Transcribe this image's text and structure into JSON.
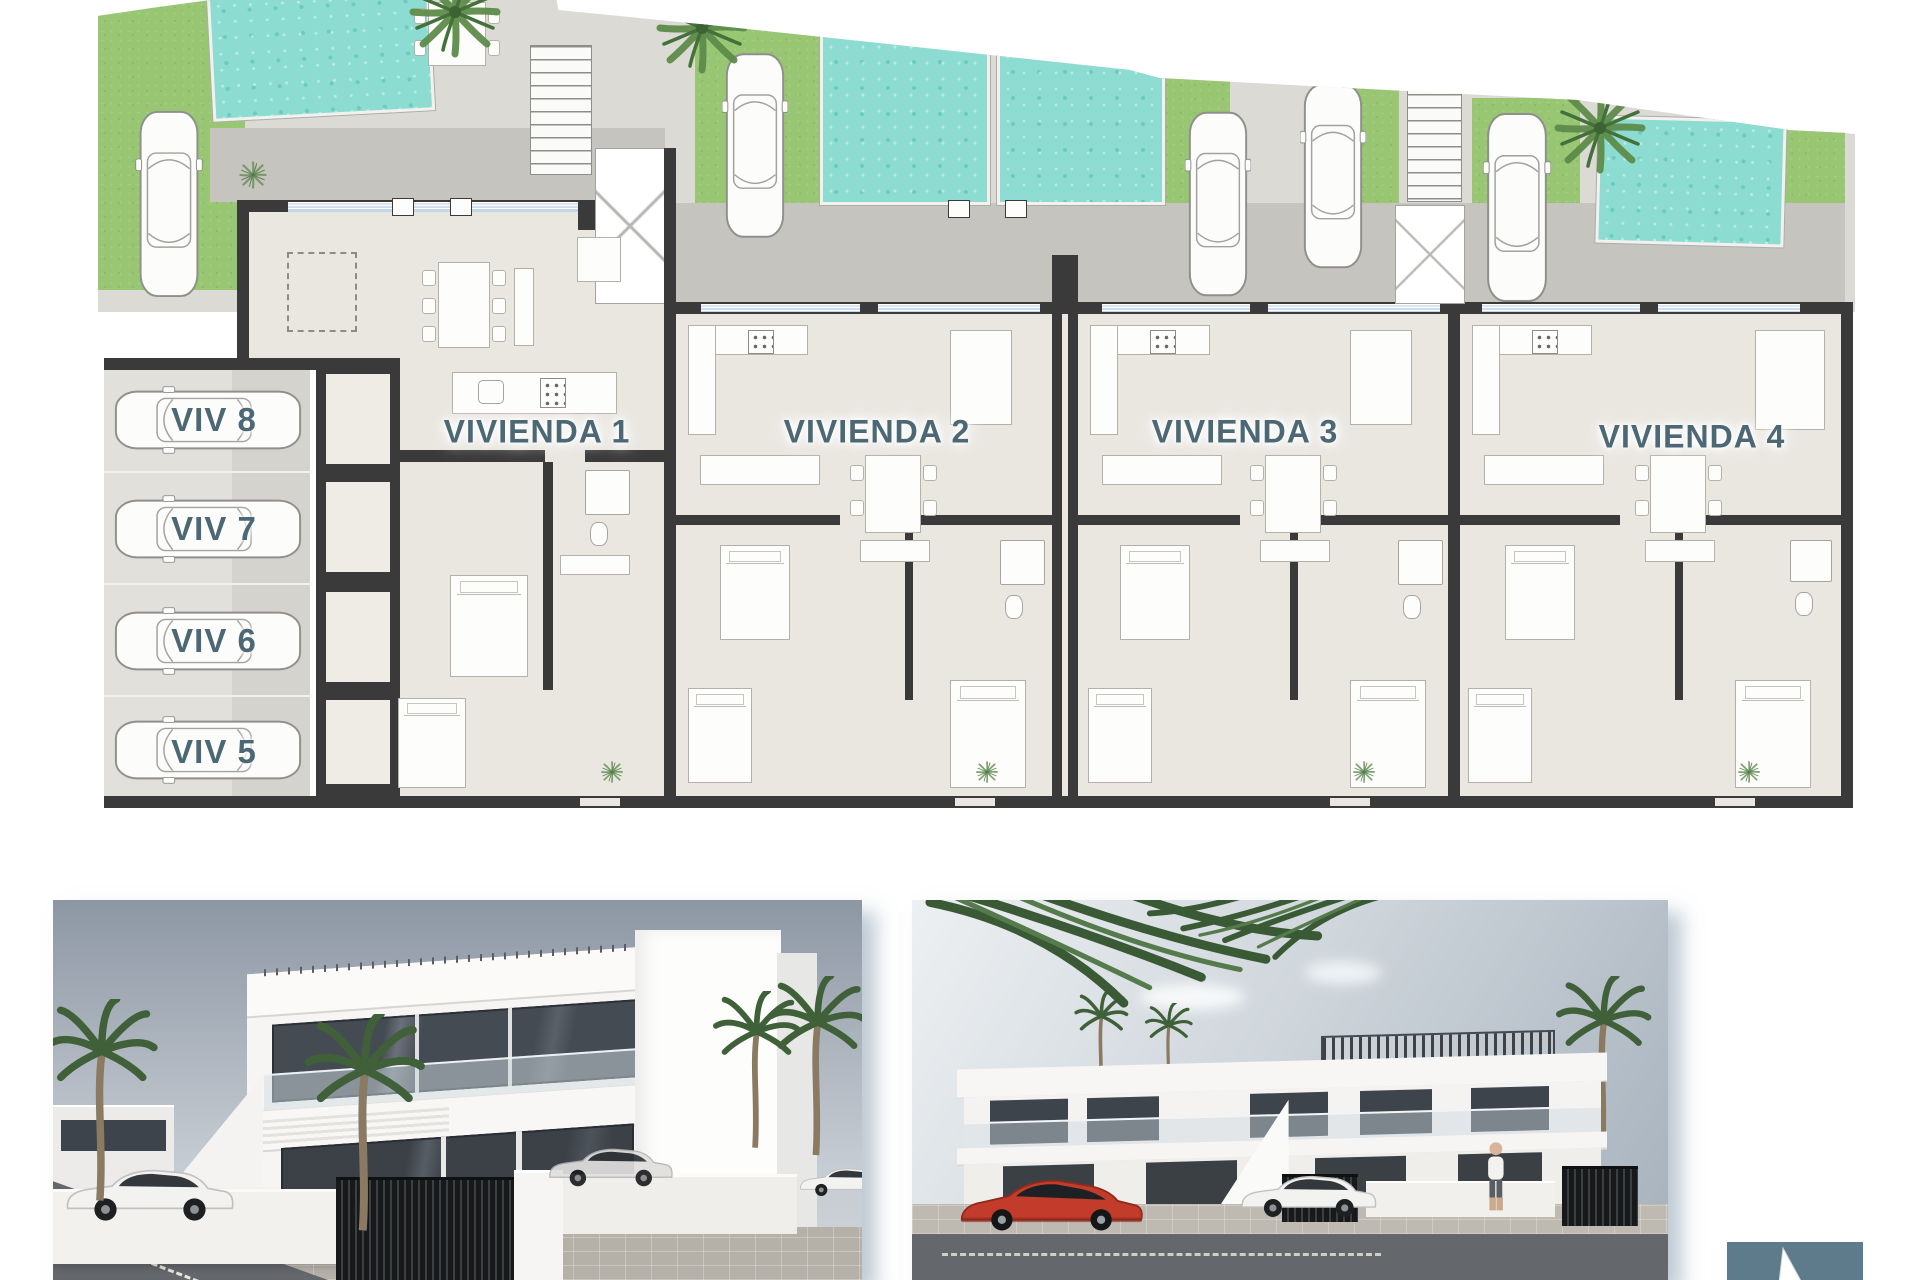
{
  "document": {
    "kind": "residential floor plan sheet with two exterior renders"
  },
  "plan": {
    "units": [
      {
        "label": "VIVIENDA 1"
      },
      {
        "label": "VIVIENDA 2"
      },
      {
        "label": "VIVIENDA 3"
      },
      {
        "label": "VIVIENDA 4"
      }
    ],
    "parking_stalls": [
      {
        "label": "VIV 8"
      },
      {
        "label": "VIV 7"
      },
      {
        "label": "VIV 6"
      },
      {
        "label": "VIV 5"
      }
    ]
  },
  "icons": {
    "car_top": "car-top-outline",
    "car_side": "car-side-silhouette",
    "palm_plan": "palm-tree-plan",
    "palm_side": "palm-tree-side",
    "stairs": "stair-steps",
    "person": "pedestrian",
    "cursor": "arrow-pointer"
  },
  "colors": {
    "paving": "#dcdad4",
    "walkway": "#c6c4be",
    "grass": "#98c673",
    "pool": "#8cdcd2",
    "wall": "#3a3a3b",
    "floor": "#eae7e1",
    "parking_left": "#e2e0da",
    "parking_right": "#d5d3cd",
    "label": "#4d6875",
    "glazing": "#dce8f2",
    "sky_top": "#8d97a4",
    "sky_bottom": "#c6ccd3",
    "sky2_top": "#edf0f2",
    "sky2_bottom": "#a6b1bc",
    "road": "#64676b",
    "sidewalk": "#b5b1a9",
    "car_red": "#c23b2b",
    "slate": "#5e7b8b",
    "palm": "#4c7046",
    "palm_dark": "#3c5c38",
    "render_building": "#f6f5f3",
    "glass_dark": "#3e444b"
  }
}
